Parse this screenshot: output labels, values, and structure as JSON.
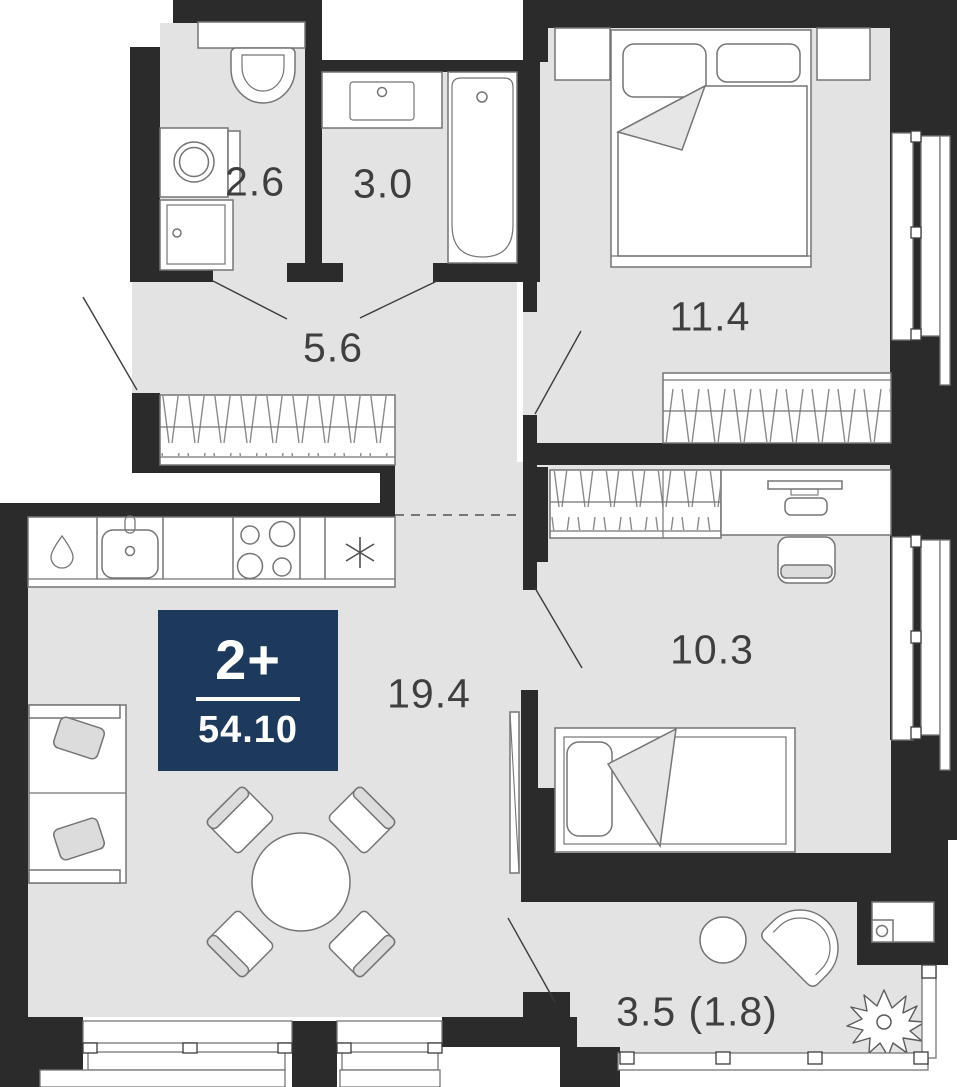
{
  "title": "Apartment floor plan",
  "badge": {
    "type": "2+",
    "area": "54.10"
  },
  "rooms": {
    "wc": {
      "area": "2.6"
    },
    "bathroom": {
      "area": "3.0"
    },
    "hallway": {
      "area": "5.6"
    },
    "bedroom": {
      "area": "11.4"
    },
    "bedroom2": {
      "area": "10.3"
    },
    "living_kitchen": {
      "area": "19.4"
    },
    "balcony": {
      "area": "3.5 (1.8)"
    }
  },
  "fixtures": [
    "toilet",
    "washing-machine",
    "bathroom-cabinet",
    "vanity-sink",
    "bathtub",
    "wardrobe",
    "kitchen-fridge",
    "kitchen-sink",
    "kitchen-counter",
    "stove-4-burners",
    "dishwasher-asterisk",
    "sofa",
    "dining-table",
    "chair",
    "double-bed",
    "nightstand",
    "desk",
    "desk-chair",
    "single-bed",
    "radiator-panel",
    "balcony-table",
    "balcony-chair",
    "plant",
    "ac-unit",
    "window",
    "door-swing"
  ],
  "colors": {
    "wall": "#2b2b2b",
    "floor": "#e3e3e3",
    "stroke": "#757575",
    "hatch": "#8b8b8b",
    "door_line": "#3c3c3c",
    "label": "#3f3f3f",
    "badge_bg": "#1d3a5c",
    "badge_text": "#ffffff",
    "soft": "#e0e0e0"
  }
}
